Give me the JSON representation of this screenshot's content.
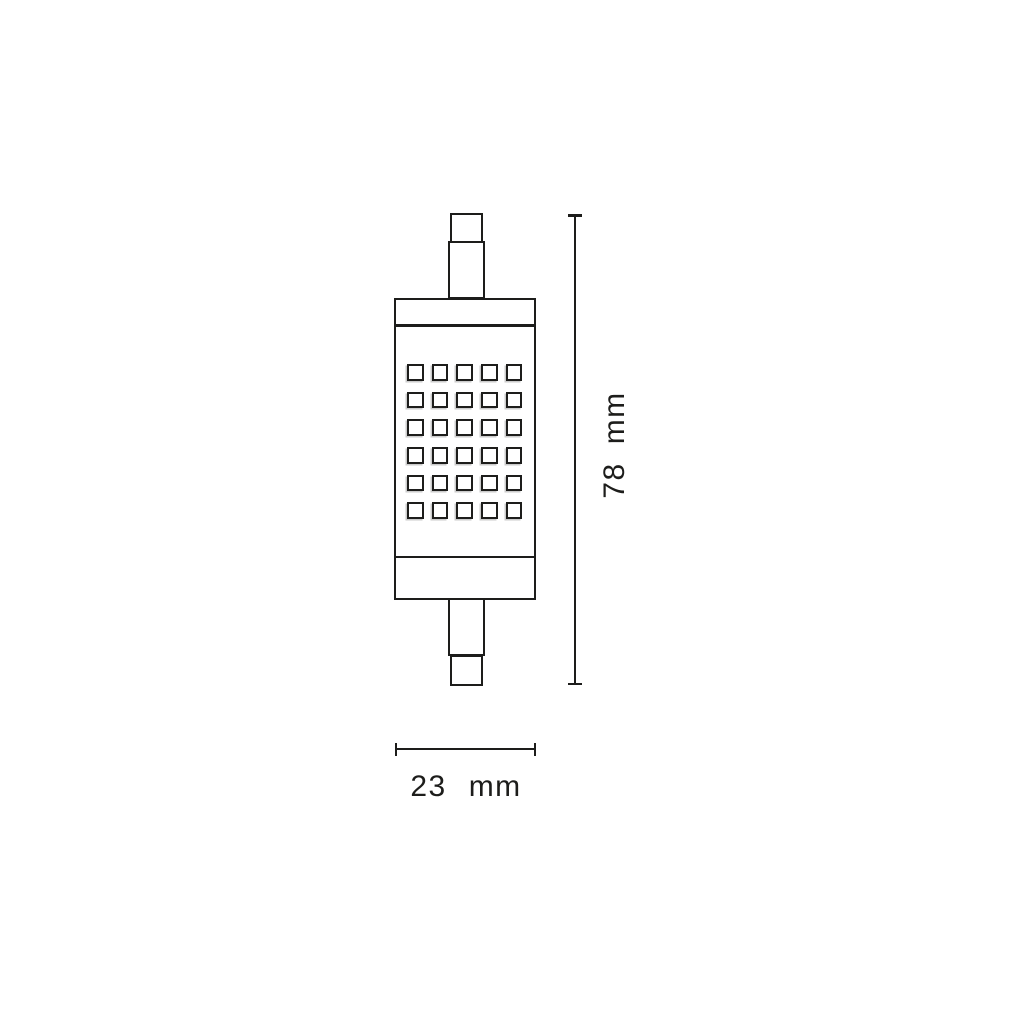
{
  "figure": {
    "kind": "technical-dimension-drawing",
    "subject": "R7s linear LED lamp, front view with dimension lines",
    "background_color": "#ffffff",
    "ink_color": "#1d1d1b"
  },
  "lamp": {
    "led_grid": {
      "rows": 6,
      "columns": 5,
      "total_chips": 30
    }
  },
  "dimensions": {
    "height": {
      "value": "78",
      "unit": "mm",
      "orientation": "vertical"
    },
    "width": {
      "value": "23",
      "unit": "mm",
      "orientation": "horizontal"
    }
  }
}
